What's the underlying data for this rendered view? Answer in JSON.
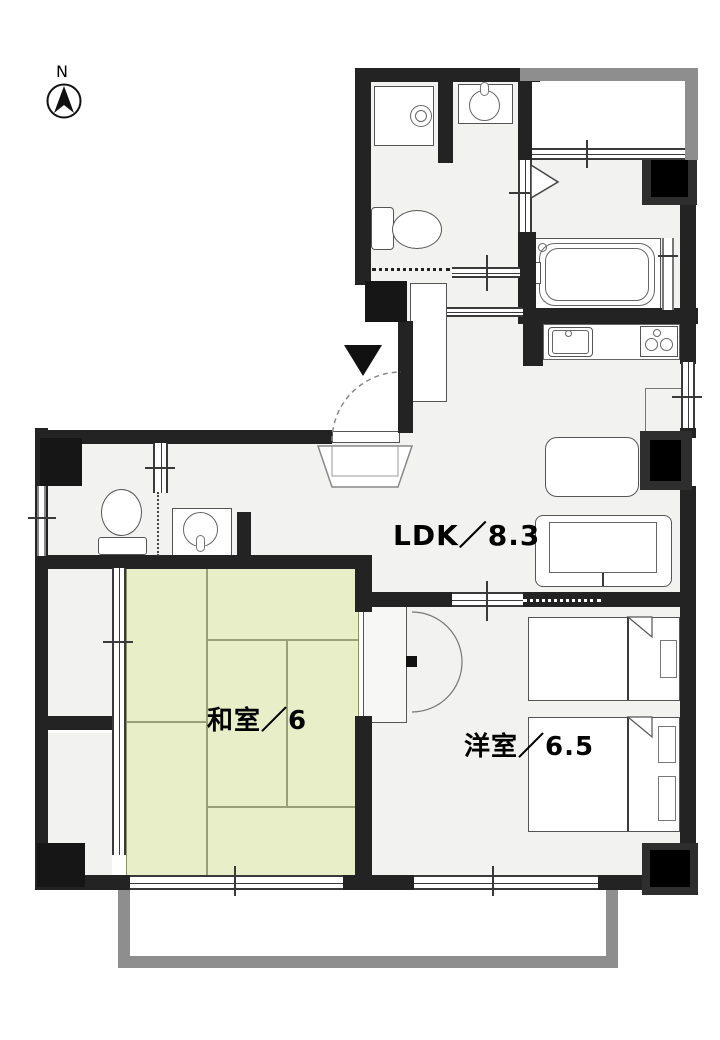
{
  "compass": {
    "label": "N"
  },
  "rooms": {
    "ldk": {
      "label": "LDK／8.3",
      "size_mats": 8.3
    },
    "japanese_room": {
      "label": "和室／6",
      "size_mats": 6
    },
    "western_room": {
      "label": "洋室／6.5",
      "size_mats": 6.5
    }
  },
  "colors": {
    "wall": "#232323",
    "floor": "#f2f2f0",
    "tatami": "#e7eec8",
    "tatami_line": "#99a077",
    "balcony": "#8e8e8e",
    "fixture": "#555555"
  },
  "fixtures": [
    "north-compass",
    "washing-machine",
    "washbasin-sanitary",
    "toilet-sanitary",
    "bathtub",
    "bathroom-folding-door",
    "kitchen-sink",
    "stove",
    "refrigerator",
    "dining-table",
    "sofa",
    "single-bed",
    "double-bed",
    "western-closet",
    "japanese-closet-upper",
    "japanese-closet-lower",
    "toilet-left",
    "washbasin-left",
    "shoe-cabinet",
    "entrance-door",
    "genkan-step",
    "entrance-marker",
    "balcony-rail"
  ]
}
